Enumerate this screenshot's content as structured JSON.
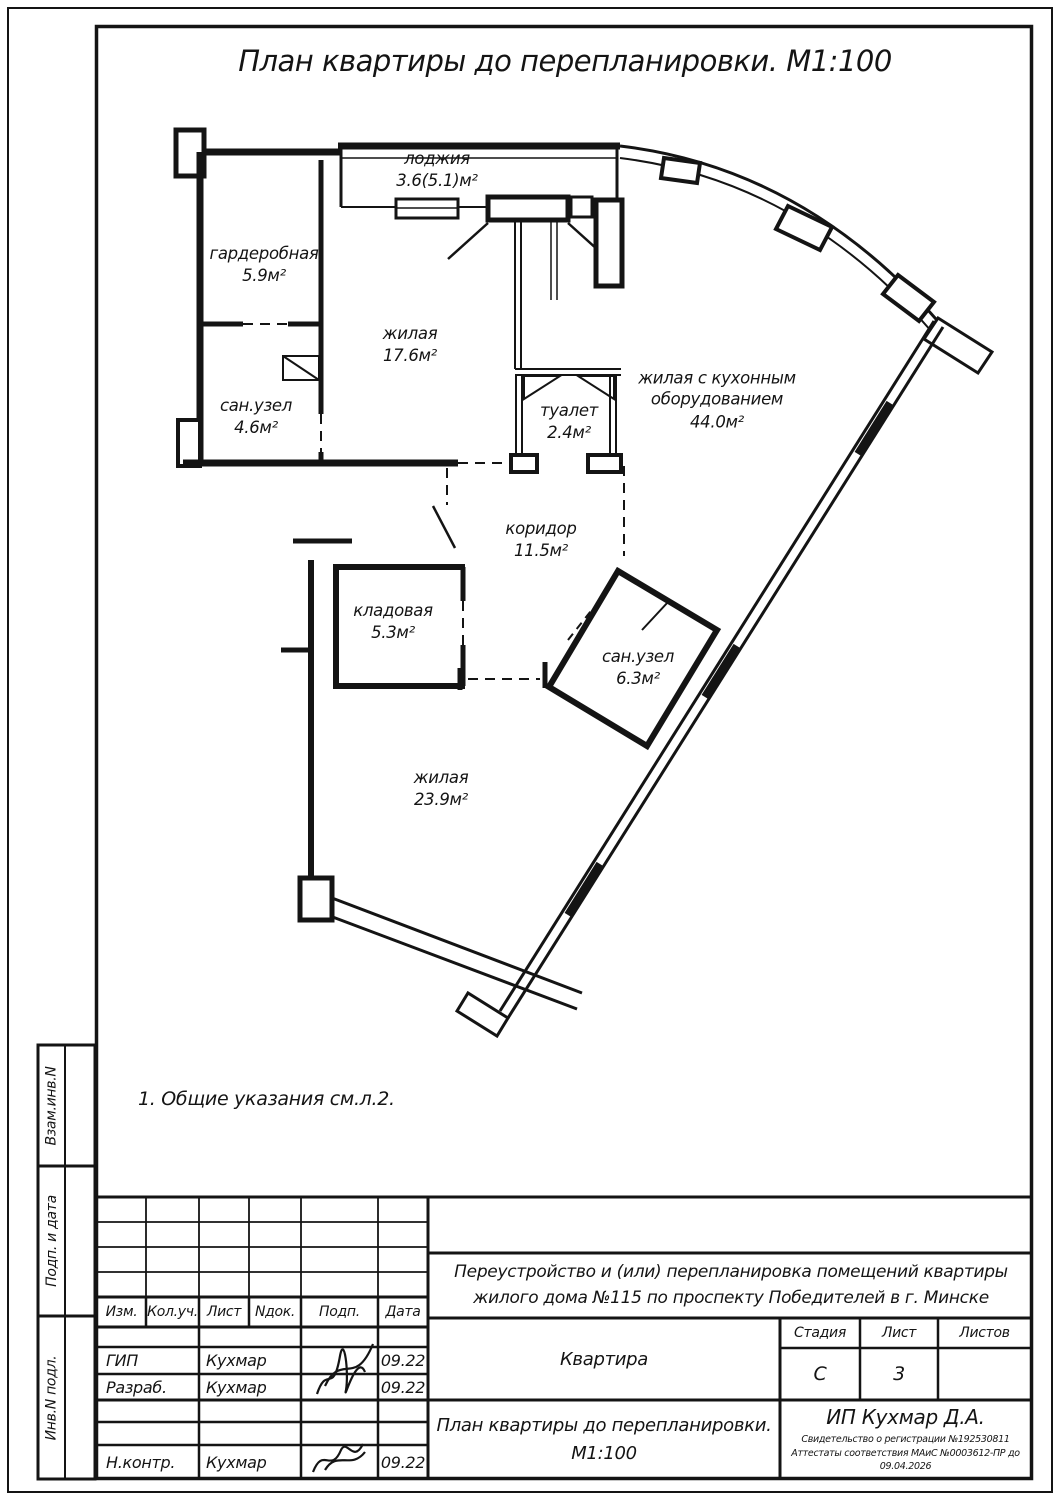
{
  "page_title": "План квартиры до перепланировки. М1:100",
  "note": "1.  Общие указания см.л.2.",
  "rooms": [
    {
      "name": "лоджия",
      "area": "3.6(5.1)м²"
    },
    {
      "name": "гардеробная",
      "area": "5.9м²"
    },
    {
      "name": "сан.узел",
      "area": "4.6м²"
    },
    {
      "name": "жилая",
      "area": "17.6м²"
    },
    {
      "name": "туалет",
      "area": "2.4м²"
    },
    {
      "name": "жилая с кухонным оборудованием",
      "area": "44.0м²"
    },
    {
      "name": "коридор",
      "area": "11.5м²"
    },
    {
      "name": "кладовая",
      "area": "5.3м²"
    },
    {
      "name": "сан.узел",
      "area": "6.3м²"
    },
    {
      "name": "жилая",
      "area": "23.9м²"
    }
  ],
  "stamp": {
    "columns": [
      "Изм.",
      "Кол.уч.",
      "Лист",
      "Nдок.",
      "Подп.",
      "Дата"
    ],
    "signers": [
      {
        "role": "ГИП",
        "name": "Кухмар",
        "date": "09.22"
      },
      {
        "role": "Разраб.",
        "name": "Кухмар",
        "date": "09.22"
      },
      {
        "role": "Н.контр.",
        "name": "Кухмар",
        "date": "09.22"
      }
    ],
    "project": "Переустройство и (или) перепланировка помещений квартиры жилого дома №115 по проспекту Победителей в г. Минске",
    "object_name": "Квартира",
    "stage_label": "Стадия",
    "stage": "С",
    "sheet_label": "Лист",
    "sheet": "3",
    "sheets_label": "Листов",
    "sheets": "",
    "doc_title": "План квартиры до перепланировки.",
    "doc_scale": "М1:100",
    "company": "ИП Кухмар Д.А.",
    "certificate1": "Свидетельство о регистрации №192530811",
    "certificate2": "Аттестаты соответствия МАиС №0003612-ПР до 09.04.2026"
  },
  "side_labels": [
    "Взам.инв.N",
    "Подп. и дата",
    "Инв.N подл."
  ]
}
